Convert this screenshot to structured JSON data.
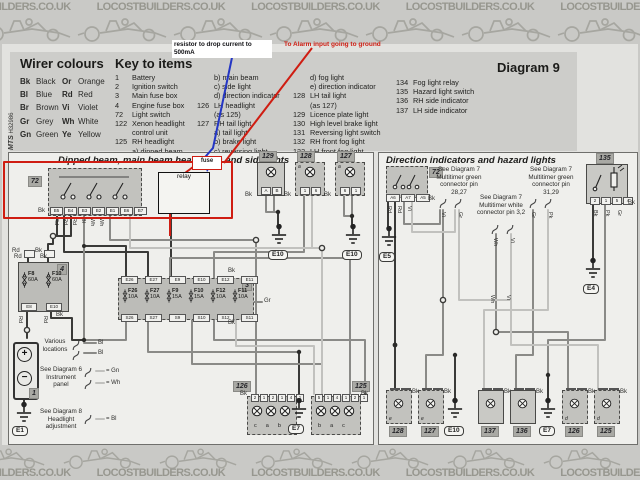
{
  "banner": {
    "texts": [
      "LOCOSTBUILDERS.CO.UK",
      "LOCOSTBUILDERS.CO.UK",
      "LOCOSTBUILDERS.CO.UK",
      "LOCOSTBUILDERS.CO.UK",
      "LOCOSTBUILDERS.CO.UK",
      "LOCOSTBUILDERS.CO.UK",
      "LOCOSTBUILDERS.CO.UK"
    ]
  },
  "key_panel": {
    "wire_colours_title": "Wirer colours",
    "wire_colours_col1": [
      {
        "code": "Bk",
        "name": "Black"
      },
      {
        "code": "Bl",
        "name": "Blue"
      },
      {
        "code": "Br",
        "name": "Brown"
      },
      {
        "code": "Gr",
        "name": "Grey"
      },
      {
        "code": "Gn",
        "name": "Green"
      }
    ],
    "wire_colours_col2": [
      {
        "code": "Or",
        "name": "Orange"
      },
      {
        "code": "Rd",
        "name": "Red"
      },
      {
        "code": "Vi",
        "name": "Violet"
      },
      {
        "code": "Wh",
        "name": "White"
      },
      {
        "code": "Ye",
        "name": "Yellow"
      }
    ],
    "key_title": "Key to items",
    "key_col1": [
      {
        "n": "1",
        "t": "Battery"
      },
      {
        "n": "2",
        "t": "Ignition switch"
      },
      {
        "n": "3",
        "t": "Main fuse box"
      },
      {
        "n": "4",
        "t": "Engine fuse box"
      },
      {
        "n": "72",
        "t": "Light switch"
      },
      {
        "n": "122",
        "t": "Xenon headlight"
      },
      {
        "n": "",
        "t": "control unit"
      },
      {
        "n": "125",
        "t": "RH headlight"
      },
      {
        "n": "",
        "t": "a) dipped beam"
      }
    ],
    "key_col2": [
      {
        "n": "",
        "t": "b) main beam"
      },
      {
        "n": "",
        "t": "c) side light"
      },
      {
        "n": "",
        "t": "d) direction indicator"
      },
      {
        "n": "126",
        "t": "LH headlight"
      },
      {
        "n": "",
        "t": "(as 125)"
      },
      {
        "n": "127",
        "t": "RH tail light"
      },
      {
        "n": "",
        "t": "a) tail light"
      },
      {
        "n": "",
        "t": "b) brake light"
      },
      {
        "n": "",
        "t": "c) reversing light"
      }
    ],
    "key_col3": [
      {
        "n": "",
        "t": "d) fog light"
      },
      {
        "n": "",
        "t": "e) direction indicator"
      },
      {
        "n": "128",
        "t": "LH tail light"
      },
      {
        "n": "",
        "t": "(as 127)"
      },
      {
        "n": "129",
        "t": "Licence plate light"
      },
      {
        "n": "130",
        "t": "High level brake light"
      },
      {
        "n": "131",
        "t": "Reversing light switch"
      },
      {
        "n": "132",
        "t": "RH front fog light"
      },
      {
        "n": "133",
        "t": "LH front fog light"
      }
    ],
    "key_col4": [
      {
        "n": "134",
        "t": "Fog light relay"
      },
      {
        "n": "135",
        "t": "Hazard light switch"
      },
      {
        "n": "136",
        "t": "RH side indicator"
      },
      {
        "n": "137",
        "t": "LH side indicator"
      }
    ],
    "diagram_label": "Diagram 9",
    "side_code_1": "MTS",
    "side_code_2": "H32986"
  },
  "annotations": {
    "resistor_note_line1": "resistor to drop current to",
    "resistor_note_line2": "500mA",
    "alarm_note": "To Alarm input going to ground",
    "fuse_label": "fuse",
    "relay_label": "relay"
  },
  "left_panel": {
    "title": "Dipped beam, main beam headlights and sidelights",
    "switch_id": "72",
    "switch_pins": [
      "B5",
      "B4",
      "B3",
      "B2",
      "B1",
      "B6",
      "B7"
    ],
    "switch_bk": "Bk",
    "switch_wires": [
      "Rd",
      "Rd",
      "Rd",
      "Bl",
      "Wh",
      "Wh"
    ],
    "conn1_left": "Rd",
    "conn1_right": "Bk",
    "light129": {
      "id": "129",
      "pins": [
        "A",
        "B"
      ],
      "bk": "Bk"
    },
    "light128": {
      "id": "128",
      "sub": "a",
      "pins": [
        "1",
        "6"
      ],
      "bk": "Bk"
    },
    "light127": {
      "id": "127",
      "sub": "a",
      "pins": [
        "6",
        "1"
      ],
      "bk": "Bk"
    },
    "ground_e10a": "E10",
    "ground_e10b": "E10",
    "ground_e1": "E1",
    "ground_e7": "E7",
    "engine_box": {
      "id": "4",
      "top_rd": "Rd",
      "top_bk": "Bk",
      "fuses": [
        {
          "name": "F8",
          "amp": "60A"
        },
        {
          "name": "F10",
          "amp": "60A"
        }
      ],
      "tabs": [
        "E8",
        "E10"
      ],
      "bk": "Bk",
      "rd_left": "Rd",
      "rd_right": "Rd"
    },
    "main_box": {
      "id": "3",
      "top_tabs": [
        "E26",
        "E27",
        "E9",
        "E10",
        "E12",
        "E11"
      ],
      "fuses": [
        {
          "name": "F26",
          "amp": "10A"
        },
        {
          "name": "F27",
          "amp": "10A"
        },
        {
          "name": "F9",
          "amp": "15A"
        },
        {
          "name": "F10",
          "amp": "15A"
        },
        {
          "name": "F12",
          "amp": "10A"
        },
        {
          "name": "F11",
          "amp": "10A"
        }
      ],
      "bottom_tabs": [
        "S26",
        "S27",
        "S9",
        "S10",
        "S12",
        "S11"
      ],
      "gr": "Gr",
      "bk_top": "Bk",
      "bk_bottom": "Bk"
    },
    "battery_id": "1",
    "battery_plus": "+",
    "battery_minus": "−",
    "note_various": "Various locations",
    "tag_bl1": "Bl",
    "tag_bl2": "Bl",
    "note_diag6": "See Diagram 6 Instrument panel",
    "tag_gn": "= Gn",
    "tag_wh": "= Wh",
    "note_diag8": "See Diagram 8 Headlight adjustment",
    "tag_bl3": "= Bl",
    "head126": {
      "id": "126",
      "pins": [
        "2",
        "1",
        "2",
        "1",
        "4",
        "1"
      ],
      "letters": [
        "c",
        "a",
        "b"
      ],
      "bk": "Bk"
    },
    "head125": {
      "id": "125",
      "pins": [
        "5",
        "1",
        "4",
        "1",
        "2",
        "1"
      ],
      "letters": [
        "b",
        "a",
        "c"
      ],
      "bk": "Bk"
    }
  },
  "right_panel": {
    "title": "Direction indicators and hazard lights",
    "switch_id": "72",
    "switch_pins": [
      "A6",
      "A7",
      "A5"
    ],
    "switch_bk": "Bk",
    "switch_wires": [
      "Rd",
      "Rd",
      "Vi"
    ],
    "note1": "See Diagram 7 Multitimer green connector pin 28,27",
    "note2": "See Diagram 7 Multitimer white connector pin 3,2",
    "note3": "See Diagram 7 Multitimer green connector pin 31,29",
    "tags1": [
      "Vi",
      "Gr"
    ],
    "tags2": [
      "Wh",
      "Vi"
    ],
    "tags3": [
      "Gr",
      "Pk"
    ],
    "hazard": {
      "id": "135",
      "pins": [
        "2",
        "1",
        "5",
        "4"
      ],
      "bk": "Bk",
      "wires": [
        "Bk",
        "Pk",
        "Gr"
      ]
    },
    "ground_e5": "E5",
    "ground_e4": "E4",
    "mid_wh": "Wh",
    "mid_vi": "Vi",
    "bottom": [
      {
        "id": "128",
        "sub": "e",
        "bk": "Bk"
      },
      {
        "id": "127",
        "sub": "e",
        "bk": "Bk"
      },
      {
        "id": "E10"
      },
      {
        "id": "137",
        "bk": "Bk"
      },
      {
        "id": "136",
        "bk": "Bk"
      },
      {
        "id": "E7"
      },
      {
        "id": "126",
        "sub": "d",
        "bk": "Bk"
      },
      {
        "id": "125",
        "sub": "d",
        "bk": "Bk"
      }
    ]
  }
}
